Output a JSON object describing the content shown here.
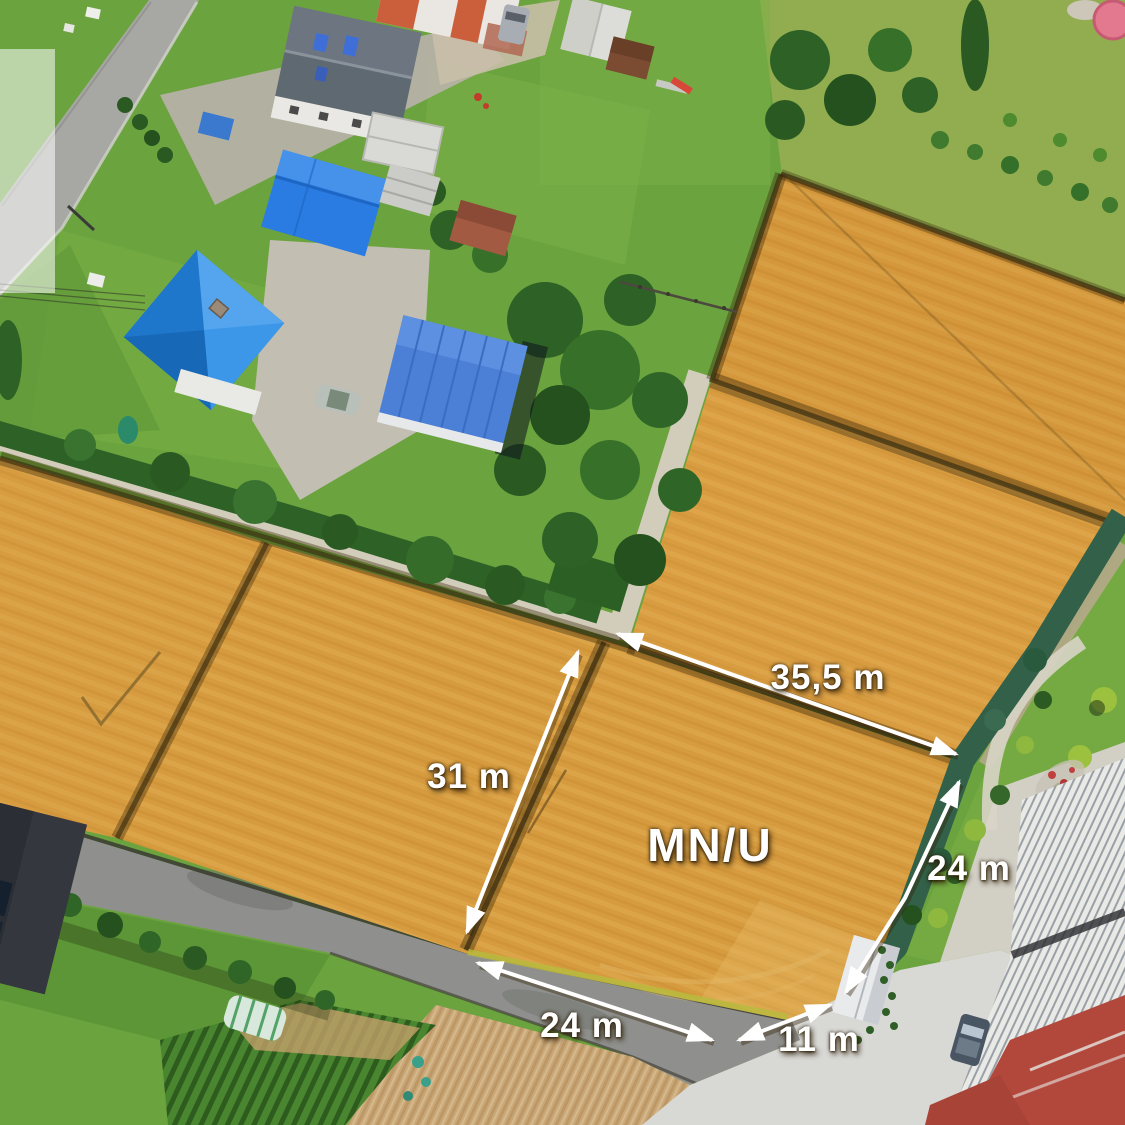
{
  "scene": {
    "description": "Aerial drone photo of building land plots for sale, bordered by houses with blue roofs, roads and gardens, with white dimension annotations drawn over the bare-soil parcels",
    "plot_label": "MN/U"
  },
  "measurements": {
    "top_diagonal": "35,5 m",
    "left_vertical": "31 m",
    "right_side": "24 m",
    "bottom_road": "24 m",
    "bottom_corner": "11 m"
  },
  "colors": {
    "field_orange": "#d79b3f",
    "grass_green": "#6ba33f",
    "roof_blue": "#2a8be2",
    "boundary_dark": "#3f3317",
    "annotation_white": "#ffffff"
  }
}
